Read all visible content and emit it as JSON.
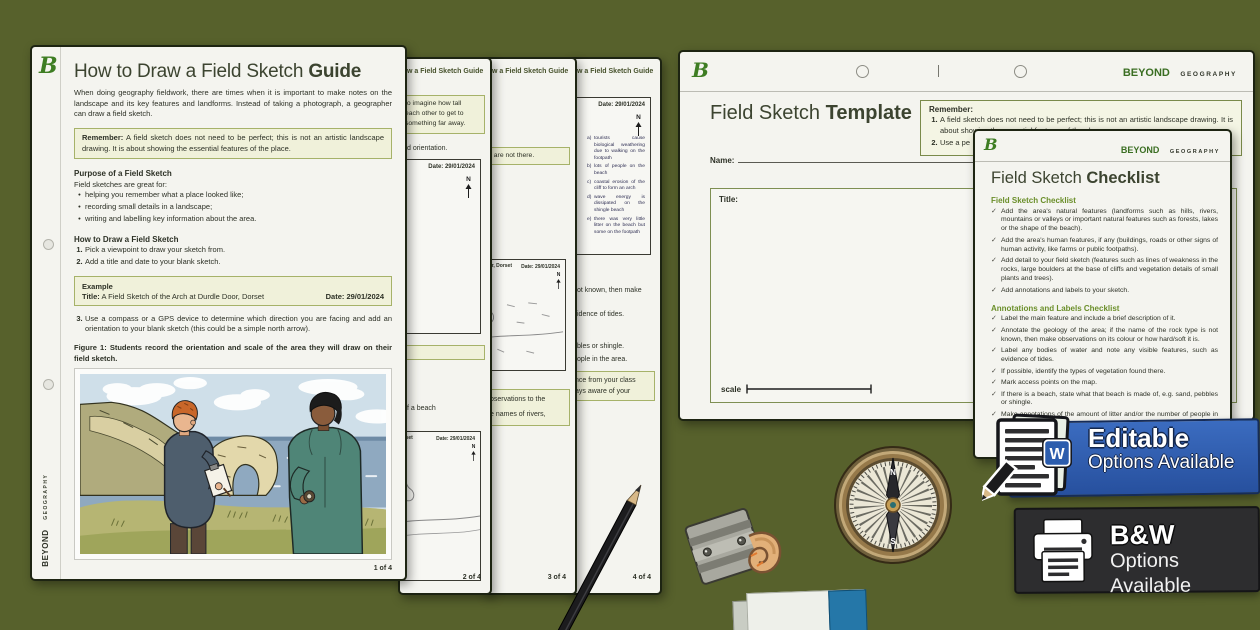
{
  "logo_letter": "B",
  "brand": {
    "beyond": "BEYOND",
    "geography": "GEOGRAPHY"
  },
  "colors": {
    "background": "#57612c",
    "brand_green": "#3e7d23",
    "heading_green": "#6b8f2a",
    "cream_box": "#f0f1da",
    "editable_blue": "#2b5cad",
    "bw_dark": "#2d2d2f"
  },
  "guide": {
    "title_main": "How to Draw a Field Sketch ",
    "title_bold": "Guide",
    "intro": "When doing geography fieldwork, there are times when it is important to make notes on the landscape and its key features and landforms. Instead of taking a photograph, a geographer can draw a field sketch.",
    "remember_label": "Remember:",
    "remember_text": " A field sketch does not need to be perfect; this is not an artistic landscape drawing. It is about showing the essential features of the place.",
    "purpose_heading": "Purpose of a Field Sketch",
    "purpose_intro": "Field sketches are great for:",
    "bullet_glyph": "•",
    "bullets": [
      "helping you remember what a place looked like;",
      "recording small details in a landscape;",
      "writing and labelling key information about the area."
    ],
    "how_heading": "How to Draw a Field Sketch",
    "steps": [
      {
        "num": "1.",
        "text": "Pick a viewpoint to draw your sketch from."
      },
      {
        "num": "2.",
        "text": "Add a title and date to your blank sketch."
      }
    ],
    "example": {
      "label": "Example",
      "title_label": "Title:",
      "title_text": " A Field Sketch of the Arch at Durdle Door, Dorset",
      "date_label": "Date:",
      "date_value": " 29/01/2024"
    },
    "step3": {
      "num": "3.",
      "text": "Use a compass or a GPS device to determine which direction you are facing and add an orientation to your blank sketch (this could be a simple north arrow)."
    },
    "figure_label": "Figure 1:",
    "figure_caption": " Students record the orientation and scale of the area they will draw on their field sketch.",
    "page_num": "1 of 4"
  },
  "strips": [
    {
      "header": "w a Field Sketch Guide",
      "page_num": "2 of 4",
      "note_lines": [
        "to imagine how tall",
        "each other to get to",
        "something far away."
      ],
      "fragment": "d orientation.",
      "date_line": "Date: 29/01/2024",
      "north": "N",
      "caption_fragment": "f a beach",
      "box2_header": "Dorset",
      "box2_date": "Date: 29/01/2024"
    },
    {
      "header": "w a Field Sketch Guide",
      "page_num": "3 of 4",
      "note_fragment": "t are not there.",
      "box_header": "Door, Dorset",
      "box_date": "Date: 29/01/2024",
      "north": "N",
      "green_lines": [
        "bservations to the",
        "e names of rivers,"
      ]
    },
    {
      "header": "w a Field Sketch Guide",
      "page_num": "4 of 4",
      "date_line": "Date: 29/01/2024",
      "north": "N",
      "annotations": [
        {
          "num": "a)",
          "text": "tourists cause biological weathering due to walking on the footpath"
        },
        {
          "num": "b)",
          "text": "lots of people on the beach"
        },
        {
          "num": "c)",
          "text": "coastal erosion of the cliff to form an arch"
        },
        {
          "num": "d)",
          "text": "wave energy is dissipated on the shingle beach"
        },
        {
          "num": "e)",
          "text": "there was very little litter on the beach but some on the footpath"
        }
      ],
      "fragments": [
        "ot known, then make",
        "idence of tides.",
        "bles or shingle.",
        "ople in the area."
      ],
      "green_lines": [
        "nce from your class",
        "ays aware of your"
      ]
    }
  ],
  "template": {
    "title_main": "Field Sketch ",
    "title_bold": "Template",
    "name_label": "Name:",
    "remember_label": "Remember:",
    "remember_items": [
      {
        "num": "1.",
        "text": "A field sketch does not need to be perfect; this is not an artistic landscape drawing. It is about showing the essential features of the place."
      },
      {
        "num": "2.",
        "text": "Use a pe"
      }
    ],
    "box_title_label": "Title:",
    "scale_label": "scale"
  },
  "checklist": {
    "title_main": "Field Sketch ",
    "title_bold": "Checklist",
    "check": "✓",
    "sections": [
      {
        "heading": "Field Sketch Checklist",
        "items": [
          "Add the area's natural features (landforms such as hills, rivers, mountains or valleys or important natural features such as forests, lakes or the shape of the beach).",
          "Add the area's human features, if any (buildings, roads or other signs of human activity, like farms or public footpaths).",
          "Add detail to your field sketch (features such as lines of weakness in the rocks, large boulders at the base of cliffs and vegetation details of small plants and trees).",
          "Add annotations and labels to your sketch."
        ]
      },
      {
        "heading": "Annotations and Labels Checklist",
        "items": [
          "Label the main feature and include a brief description of it.",
          "Annotate the geology of the area; if the name of the rock type is not known, then make observations on its colour or how hard/soft it is.",
          "Label any bodies of water and note any visible features, such as evidence of tides.",
          "If possible, identify the types of vegetation found there.",
          "Mark access points on the map.",
          "If there is a beach, state what that beach is made of, e.g. sand, pebbles or shingle.",
          "Make annotations of the amount of litter and/or the number of people in the area."
        ]
      }
    ]
  },
  "badges": {
    "editable": {
      "title": "Editable",
      "subtitle": "Options Available",
      "w_letter": "W"
    },
    "bw": {
      "title": "B&W",
      "subtitle": "Options Available"
    }
  },
  "compass": {
    "north": "N",
    "south": "S"
  }
}
